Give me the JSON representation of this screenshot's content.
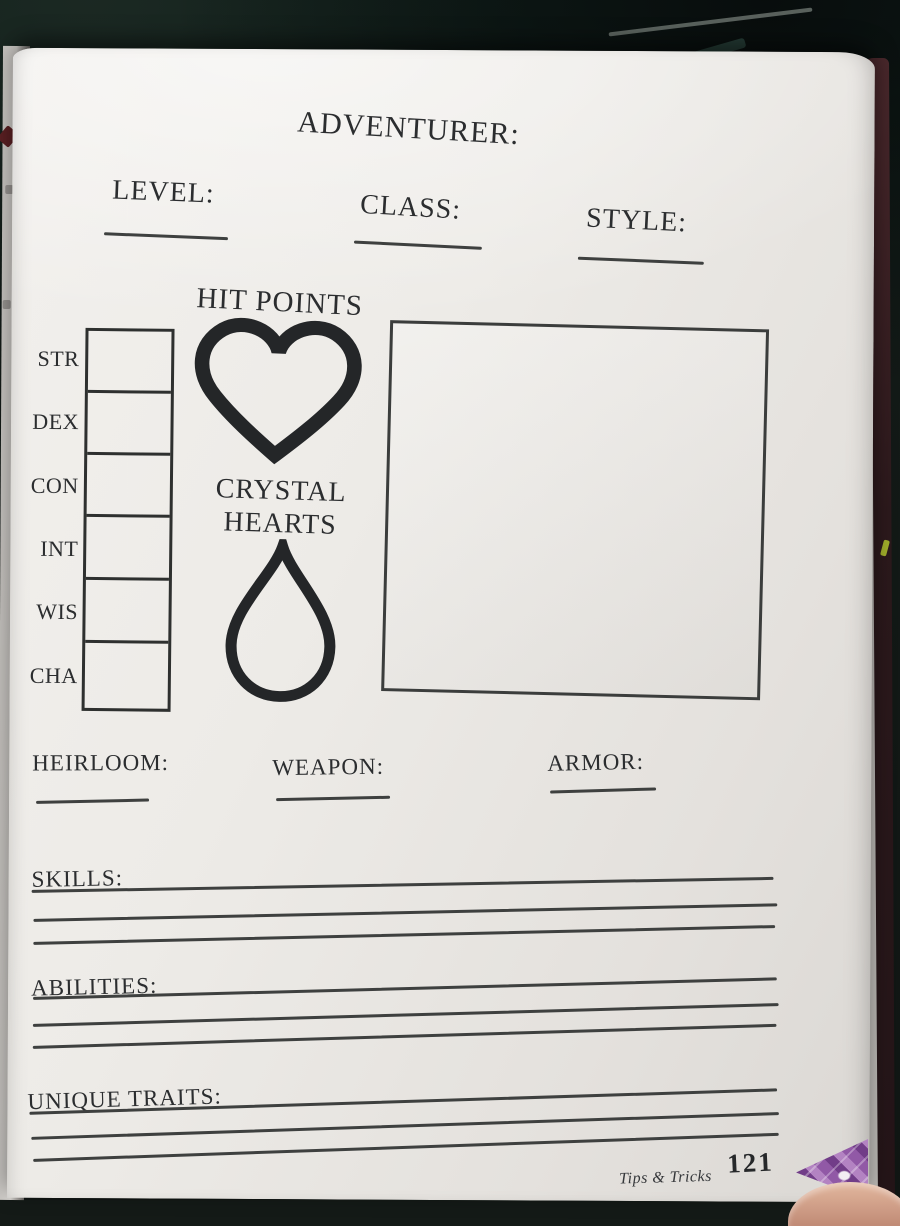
{
  "sheet": {
    "title": "ADVENTURER:",
    "top_fields": [
      {
        "label": "LEVEL:"
      },
      {
        "label": "CLASS:"
      },
      {
        "label": "STYLE:"
      }
    ],
    "hit_points_label": "HIT POINTS",
    "crystal_hearts_line1": "CRYSTAL",
    "crystal_hearts_line2": "HEARTS",
    "stats": [
      {
        "label": "STR"
      },
      {
        "label": "DEX"
      },
      {
        "label": "CON"
      },
      {
        "label": "INT"
      },
      {
        "label": "WIS"
      },
      {
        "label": "CHA"
      }
    ],
    "equipment_fields": [
      {
        "label": "HEIRLOOM:"
      },
      {
        "label": "WEAPON:"
      },
      {
        "label": "ARMOR:"
      }
    ],
    "line_sections": [
      {
        "label": "SKILLS:",
        "blank_lines": 3
      },
      {
        "label": "ABILITIES:",
        "blank_lines": 3
      },
      {
        "label": "UNIQUE TRAITS:",
        "blank_lines": 3
      }
    ],
    "icons": {
      "hit_points": "heart-outline-icon",
      "crystal_hearts": "teardrop-outline-icon"
    }
  },
  "footer": {
    "book_title": "Tips & Tricks",
    "page_number": "121"
  },
  "colors": {
    "ink": "#2b2d2f",
    "page": "#edebe7",
    "background": "#141a17",
    "cover_maroon": "#3a2023",
    "decoration_purple": "#8d4f9e"
  }
}
